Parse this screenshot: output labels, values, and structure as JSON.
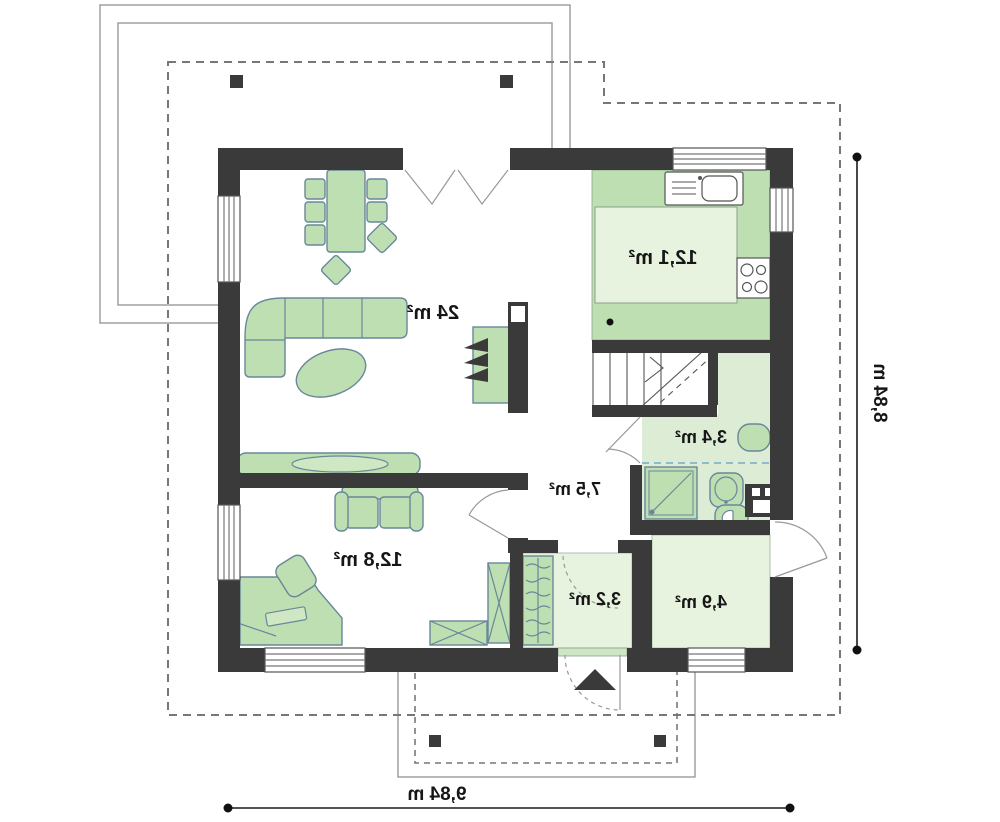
{
  "plan": {
    "rooms": [
      {
        "name": "living-room",
        "area_label": "24 m²"
      },
      {
        "name": "kitchen",
        "area_label": "12,1 m²"
      },
      {
        "name": "bathroom",
        "area_label": "3,4 m²"
      },
      {
        "name": "hall",
        "area_label": "7,5 m²"
      },
      {
        "name": "bedroom",
        "area_label": "12,8 m²"
      },
      {
        "name": "vestibule",
        "area_label": "3,2 m²"
      },
      {
        "name": "utility-room",
        "area_label": "4,9 m²"
      }
    ],
    "dimensions": {
      "overall_depth": "8,84 m",
      "overall_width": "9,84 m"
    },
    "colors": {
      "wall": "#3a3a3a",
      "furniture_fill": "#bedfb2",
      "furniture_stroke": "#69879a",
      "floor_light": "#e8f3df",
      "bathroom_floor": "#ddecd5",
      "kitchen_floor": "#bedfb2",
      "roof_outline": "#777777",
      "privacy_line": "#74aac6",
      "dimension_text": "#1a1a1a"
    }
  }
}
